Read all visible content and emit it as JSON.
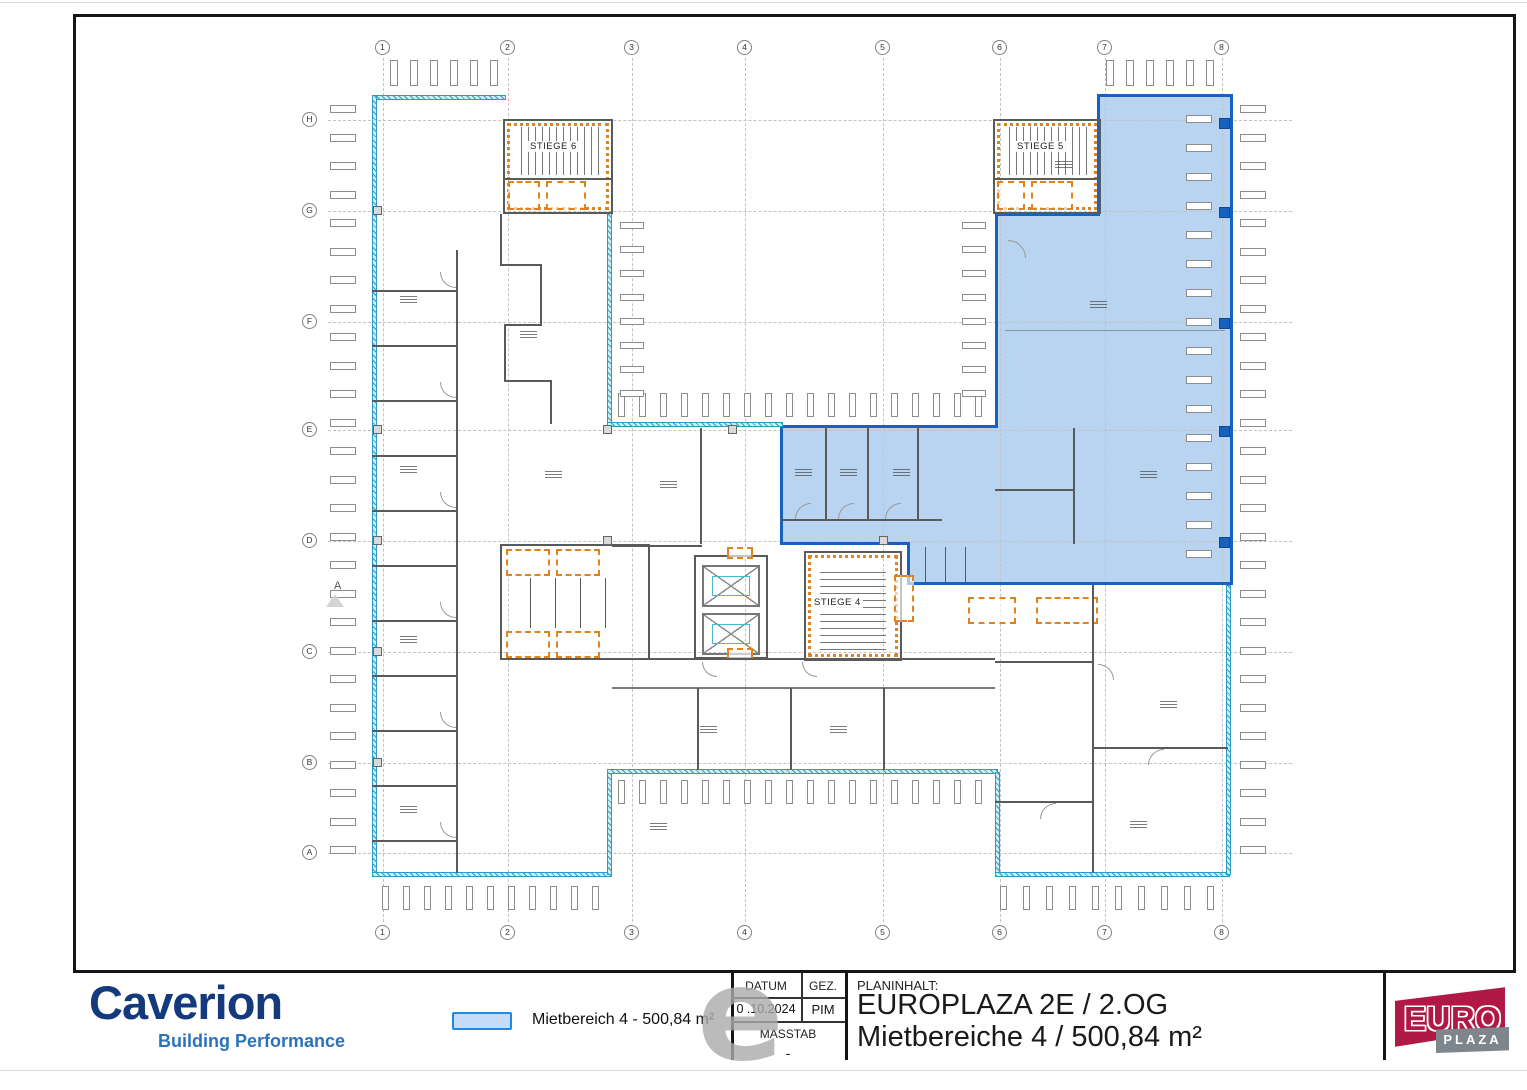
{
  "page": {
    "watermark_letter": "e"
  },
  "plan": {
    "grid_columns": [
      "1",
      "2",
      "3",
      "4",
      "5",
      "6",
      "7",
      "8"
    ],
    "grid_rows": [
      "H",
      "G",
      "F",
      "E",
      "D",
      "C",
      "B",
      "A"
    ],
    "stairwells": {
      "stiege6": "STIEGE 6",
      "stiege5": "STIEGE 5",
      "stiege4": "STIEGE 4"
    },
    "section_marker": "A",
    "highlight": {
      "name": "Mietbereich 4",
      "fill": "#b9d4f1",
      "border": "#1563be"
    },
    "wall_colors": {
      "exterior": "#3eafd3",
      "stair": "#e0821e",
      "interior": "#5a5a5a"
    }
  },
  "legend": {
    "label": "Mietbereich 4 - 500,84 m²",
    "swatch_fill": "#c5dcf8",
    "swatch_border": "#1e88e5"
  },
  "title_block": {
    "datum_label": "DATUM",
    "datum_value": "0 .10.2024",
    "gez_label": "GEZ.",
    "gez_value": "PIM",
    "masstab_label": "MASSTAB",
    "masstab_value": "-",
    "planinhalt_label": "PLANINHALT:",
    "title_line1": "EUROPLAZA 2E / 2.OG",
    "title_line2": "Mietbereiche 4 / 500,84 m²"
  },
  "branding": {
    "caverion_name": "Caverion",
    "caverion_tagline": "Building Performance",
    "caverion_color": "#143a7d",
    "tagline_color": "#2a72bc",
    "europlaza_line1": "EURO",
    "europlaza_line2": "PLAZA",
    "euro_red": "#b01945",
    "plaza_gray": "#7d868c"
  }
}
